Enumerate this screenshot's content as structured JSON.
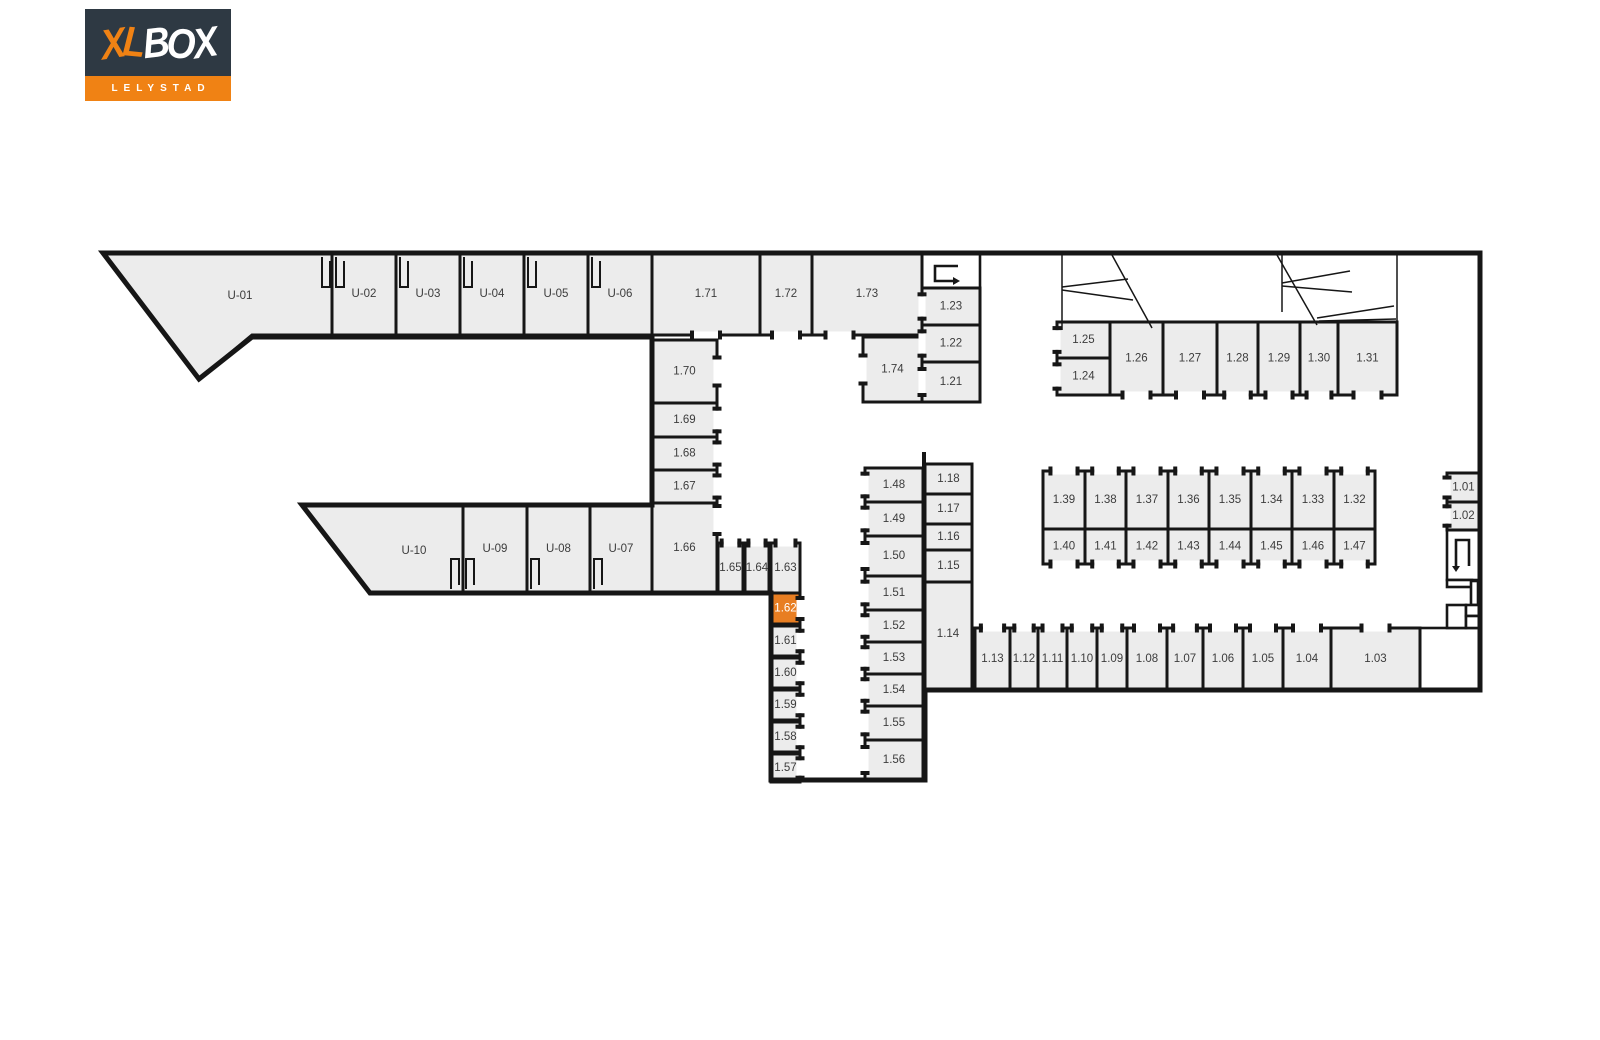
{
  "logo": {
    "brand_xl": "XL",
    "brand_box": "BOX",
    "city": "LELYSTAD"
  },
  "colors": {
    "highlight": "#E87E22",
    "unit_fill": "#ECECEC",
    "open_fill": "#FFFFFF",
    "wall": "#161616",
    "label": "#3C3C3C",
    "highlight_label": "#FFFFFF",
    "logo_bg": "#2E3943",
    "logo_orange": "#F08214"
  },
  "floorplan": {
    "units": [
      {
        "id": "U-01",
        "pts": [
          [
            103,
            253
          ],
          [
            332,
            253
          ],
          [
            332,
            335
          ],
          [
            252,
            335
          ],
          [
            199,
            379
          ]
        ],
        "lx": 240,
        "ly": 296
      },
      {
        "id": "U-02",
        "x": 332,
        "y": 253,
        "w": 64,
        "h": 82
      },
      {
        "id": "U-03",
        "x": 396,
        "y": 253,
        "w": 64,
        "h": 82
      },
      {
        "id": "U-04",
        "x": 460,
        "y": 253,
        "w": 64,
        "h": 82
      },
      {
        "id": "U-05",
        "x": 524,
        "y": 253,
        "w": 64,
        "h": 82
      },
      {
        "id": "U-06",
        "x": 588,
        "y": 253,
        "w": 64,
        "h": 82
      },
      {
        "id": "1.71",
        "x": 652,
        "y": 253,
        "w": 108,
        "h": 82,
        "door": [
          "bottom",
          0.5
        ]
      },
      {
        "id": "1.72",
        "x": 760,
        "y": 253,
        "w": 52,
        "h": 82,
        "door": [
          "bottom",
          0.5
        ]
      },
      {
        "id": "1.73",
        "x": 812,
        "y": 253,
        "w": 110,
        "h": 82,
        "door": [
          "bottom",
          0.25
        ]
      },
      {
        "id": "1.74",
        "x": 863,
        "y": 337,
        "w": 59,
        "h": 65,
        "door": [
          "left",
          0.5
        ]
      },
      {
        "id": "1.23",
        "x": 922,
        "y": 288,
        "w": 58,
        "h": 37,
        "door": [
          "left",
          0.5
        ]
      },
      {
        "id": "1.22",
        "x": 922,
        "y": 325,
        "w": 58,
        "h": 37,
        "door": [
          "left",
          0.5
        ]
      },
      {
        "id": "1.21",
        "x": 922,
        "y": 362,
        "w": 58,
        "h": 40,
        "door": [
          "left",
          0.5
        ]
      },
      {
        "id": "1.70",
        "x": 652,
        "y": 340,
        "w": 65,
        "h": 63,
        "door": [
          "right",
          0.5
        ]
      },
      {
        "id": "1.69",
        "x": 652,
        "y": 403,
        "w": 65,
        "h": 34,
        "door": [
          "right",
          0.5
        ]
      },
      {
        "id": "1.68",
        "x": 652,
        "y": 437,
        "w": 65,
        "h": 33,
        "door": [
          "right",
          0.5
        ]
      },
      {
        "id": "1.67",
        "x": 652,
        "y": 470,
        "w": 65,
        "h": 33,
        "door": [
          "right",
          0.5
        ]
      },
      {
        "id": "1.66",
        "x": 652,
        "y": 503,
        "w": 65,
        "h": 90,
        "door": [
          "right",
          0.18
        ]
      },
      {
        "id": "U-10",
        "pts": [
          [
            302,
            505
          ],
          [
            463,
            505
          ],
          [
            463,
            593
          ],
          [
            370,
            593
          ]
        ],
        "lx": 414,
        "ly": 551
      },
      {
        "id": "U-09",
        "x": 463,
        "y": 505,
        "w": 64,
        "h": 88
      },
      {
        "id": "U-08",
        "x": 527,
        "y": 505,
        "w": 63,
        "h": 88
      },
      {
        "id": "U-07",
        "x": 590,
        "y": 505,
        "w": 62,
        "h": 88
      },
      {
        "id": "1.65",
        "x": 718,
        "y": 543,
        "w": 25,
        "h": 50,
        "door": [
          "top",
          0.5
        ]
      },
      {
        "id": "1.64",
        "x": 745,
        "y": 543,
        "w": 24,
        "h": 50,
        "door": [
          "top",
          0.5
        ]
      },
      {
        "id": "1.63",
        "x": 771,
        "y": 543,
        "w": 29,
        "h": 50,
        "door": [
          "top",
          0.5
        ]
      },
      {
        "id": "1.62",
        "x": 771,
        "y": 593,
        "w": 29,
        "h": 31,
        "hl": true,
        "door": [
          "right",
          0.5
        ]
      },
      {
        "id": "1.61",
        "x": 771,
        "y": 626,
        "w": 29,
        "h": 30,
        "door": [
          "right",
          0.5
        ]
      },
      {
        "id": "1.60",
        "x": 771,
        "y": 658,
        "w": 29,
        "h": 30,
        "door": [
          "right",
          0.5
        ]
      },
      {
        "id": "1.59",
        "x": 771,
        "y": 690,
        "w": 29,
        "h": 30,
        "door": [
          "right",
          0.5
        ]
      },
      {
        "id": "1.58",
        "x": 771,
        "y": 722,
        "w": 29,
        "h": 30,
        "door": [
          "right",
          0.5
        ]
      },
      {
        "id": "1.57",
        "x": 771,
        "y": 754,
        "w": 29,
        "h": 28,
        "door": [
          "right",
          0.5
        ]
      },
      {
        "id": "1.48",
        "x": 865,
        "y": 468,
        "w": 58,
        "h": 34,
        "door": [
          "left",
          0.5
        ]
      },
      {
        "id": "1.49",
        "x": 865,
        "y": 502,
        "w": 58,
        "h": 34,
        "door": [
          "left",
          0.5
        ]
      },
      {
        "id": "1.50",
        "x": 865,
        "y": 536,
        "w": 58,
        "h": 40,
        "door": [
          "left",
          0.5
        ]
      },
      {
        "id": "1.51",
        "x": 865,
        "y": 576,
        "w": 58,
        "h": 34,
        "door": [
          "left",
          0.5
        ]
      },
      {
        "id": "1.52",
        "x": 865,
        "y": 610,
        "w": 58,
        "h": 32,
        "door": [
          "left",
          0.5
        ]
      },
      {
        "id": "1.53",
        "x": 865,
        "y": 642,
        "w": 58,
        "h": 32,
        "door": [
          "left",
          0.5
        ]
      },
      {
        "id": "1.54",
        "x": 865,
        "y": 674,
        "w": 58,
        "h": 32,
        "door": [
          "left",
          0.5
        ]
      },
      {
        "id": "1.55",
        "x": 865,
        "y": 706,
        "w": 58,
        "h": 34,
        "door": [
          "left",
          0.5
        ]
      },
      {
        "id": "1.56",
        "x": 865,
        "y": 740,
        "w": 58,
        "h": 40,
        "door": [
          "left",
          0.5
        ]
      },
      {
        "id": "1.18",
        "x": 925,
        "y": 464,
        "w": 47,
        "h": 30
      },
      {
        "id": "1.17",
        "x": 925,
        "y": 494,
        "w": 47,
        "h": 30
      },
      {
        "id": "1.16",
        "x": 925,
        "y": 524,
        "w": 47,
        "h": 26
      },
      {
        "id": "1.15",
        "x": 925,
        "y": 550,
        "w": 47,
        "h": 32
      },
      {
        "id": "1.14",
        "x": 925,
        "y": 582,
        "w": 47,
        "h": 108,
        "lx": 948,
        "ly": 634
      },
      {
        "id": "1.13",
        "x": 975,
        "y": 628,
        "w": 35,
        "h": 62,
        "door": [
          "top",
          0.5
        ]
      },
      {
        "id": "1.12",
        "x": 1010,
        "y": 628,
        "w": 28,
        "h": 62,
        "door": [
          "top",
          0.5
        ]
      },
      {
        "id": "1.11",
        "x": 1038,
        "y": 628,
        "w": 29,
        "h": 62,
        "door": [
          "top",
          0.5
        ]
      },
      {
        "id": "1.10",
        "x": 1067,
        "y": 628,
        "w": 30,
        "h": 62,
        "door": [
          "top",
          0.5
        ]
      },
      {
        "id": "1.09",
        "x": 1097,
        "y": 628,
        "w": 30,
        "h": 62,
        "door": [
          "top",
          0.5
        ]
      },
      {
        "id": "1.08",
        "x": 1127,
        "y": 628,
        "w": 40,
        "h": 62,
        "door": [
          "top",
          0.5
        ]
      },
      {
        "id": "1.07",
        "x": 1167,
        "y": 628,
        "w": 36,
        "h": 62,
        "door": [
          "top",
          0.5
        ]
      },
      {
        "id": "1.06",
        "x": 1203,
        "y": 628,
        "w": 40,
        "h": 62,
        "door": [
          "top",
          0.5
        ]
      },
      {
        "id": "1.05",
        "x": 1243,
        "y": 628,
        "w": 40,
        "h": 62,
        "door": [
          "top",
          0.5
        ]
      },
      {
        "id": "1.04",
        "x": 1283,
        "y": 628,
        "w": 48,
        "h": 62,
        "door": [
          "top",
          0.5
        ]
      },
      {
        "id": "1.03",
        "x": 1331,
        "y": 628,
        "w": 89,
        "h": 62,
        "door": [
          "top",
          0.5
        ]
      },
      {
        "id": "1.25",
        "x": 1057,
        "y": 322,
        "w": 53,
        "h": 36,
        "door": [
          "left",
          0.5
        ]
      },
      {
        "id": "1.24",
        "x": 1057,
        "y": 358,
        "w": 53,
        "h": 37,
        "door": [
          "left",
          0.5
        ]
      },
      {
        "id": "1.26",
        "x": 1110,
        "y": 322,
        "w": 53,
        "h": 73,
        "door": [
          "bottom",
          0.5
        ]
      },
      {
        "id": "1.27",
        "x": 1163,
        "y": 322,
        "w": 54,
        "h": 73,
        "door": [
          "bottom",
          0.5
        ]
      },
      {
        "id": "1.28",
        "x": 1217,
        "y": 322,
        "w": 41,
        "h": 73,
        "door": [
          "bottom",
          0.5
        ]
      },
      {
        "id": "1.29",
        "x": 1258,
        "y": 322,
        "w": 42,
        "h": 73,
        "door": [
          "bottom",
          0.5
        ]
      },
      {
        "id": "1.30",
        "x": 1300,
        "y": 322,
        "w": 38,
        "h": 73,
        "door": [
          "bottom",
          0.5
        ]
      },
      {
        "id": "1.31",
        "x": 1338,
        "y": 322,
        "w": 59,
        "h": 73,
        "door": [
          "bottom",
          0.5
        ]
      },
      {
        "id": "1.39",
        "x": 1043,
        "y": 471,
        "w": 42,
        "h": 58,
        "door": [
          "top",
          0.5
        ]
      },
      {
        "id": "1.38",
        "x": 1085,
        "y": 471,
        "w": 41,
        "h": 58,
        "door": [
          "top",
          0.5
        ]
      },
      {
        "id": "1.37",
        "x": 1126,
        "y": 471,
        "w": 42,
        "h": 58,
        "door": [
          "top",
          0.5
        ]
      },
      {
        "id": "1.36",
        "x": 1168,
        "y": 471,
        "w": 41,
        "h": 58,
        "door": [
          "top",
          0.5
        ]
      },
      {
        "id": "1.35",
        "x": 1209,
        "y": 471,
        "w": 42,
        "h": 58,
        "door": [
          "top",
          0.5
        ]
      },
      {
        "id": "1.34",
        "x": 1251,
        "y": 471,
        "w": 41,
        "h": 58,
        "door": [
          "top",
          0.5
        ]
      },
      {
        "id": "1.33",
        "x": 1292,
        "y": 471,
        "w": 42,
        "h": 58,
        "door": [
          "top",
          0.5
        ]
      },
      {
        "id": "1.32",
        "x": 1334,
        "y": 471,
        "w": 41,
        "h": 58,
        "door": [
          "top",
          0.5
        ]
      },
      {
        "id": "1.40",
        "x": 1043,
        "y": 529,
        "w": 42,
        "h": 35,
        "door": [
          "bottom",
          0.5
        ]
      },
      {
        "id": "1.41",
        "x": 1085,
        "y": 529,
        "w": 41,
        "h": 35,
        "door": [
          "bottom",
          0.5
        ]
      },
      {
        "id": "1.42",
        "x": 1126,
        "y": 529,
        "w": 42,
        "h": 35,
        "door": [
          "bottom",
          0.5
        ]
      },
      {
        "id": "1.43",
        "x": 1168,
        "y": 529,
        "w": 41,
        "h": 35,
        "door": [
          "bottom",
          0.5
        ]
      },
      {
        "id": "1.44",
        "x": 1209,
        "y": 529,
        "w": 42,
        "h": 35,
        "door": [
          "bottom",
          0.5
        ]
      },
      {
        "id": "1.45",
        "x": 1251,
        "y": 529,
        "w": 41,
        "h": 35,
        "door": [
          "bottom",
          0.5
        ]
      },
      {
        "id": "1.46",
        "x": 1292,
        "y": 529,
        "w": 42,
        "h": 35,
        "door": [
          "bottom",
          0.5
        ]
      },
      {
        "id": "1.47",
        "x": 1334,
        "y": 529,
        "w": 41,
        "h": 35,
        "door": [
          "bottom",
          0.5
        ]
      },
      {
        "id": "1.01",
        "x": 1447,
        "y": 473,
        "w": 33,
        "h": 29,
        "door": [
          "left",
          0.5
        ]
      },
      {
        "id": "1.02",
        "x": 1447,
        "y": 502,
        "w": 33,
        "h": 28,
        "door": [
          "left",
          0.5
        ]
      }
    ],
    "open_rooms": [
      {
        "name": "stairwell-top",
        "x": 922,
        "y": 253,
        "w": 58,
        "h": 35
      },
      {
        "name": "stairwell-right",
        "x": 1447,
        "y": 530,
        "w": 33,
        "h": 50
      },
      {
        "name": "utility-room",
        "x": 1420,
        "y": 628,
        "w": 60,
        "h": 62
      },
      {
        "name": "utility-room",
        "x": 1447,
        "y": 580,
        "w": 25,
        "h": 7
      },
      {
        "name": "utility-room",
        "x": 1471,
        "y": 581,
        "w": 7,
        "h": 24
      },
      {
        "name": "utility-room",
        "x": 1447,
        "y": 605,
        "w": 19,
        "h": 23
      },
      {
        "name": "utility-room",
        "x": 1466,
        "y": 605,
        "w": 14,
        "h": 11
      },
      {
        "name": "utility-room",
        "x": 1466,
        "y": 616,
        "w": 14,
        "h": 12
      }
    ],
    "outline": "M103,253 L1480,253 L1480,690 L925,690 L925,780 L771,780 L771,593 L370,593 L302,505 L652,505 L652,337 L252,337 L199,379 Z",
    "extra_walls": [
      [
        924,
        452,
        924,
        468
      ]
    ],
    "gates": [
      [
        1062,
        255,
        1062,
        330
      ],
      [
        1062,
        287,
        1128,
        279
      ],
      [
        1062,
        290,
        1133,
        300
      ],
      [
        1112,
        255,
        1152,
        328
      ],
      [
        1282,
        255,
        1282,
        312
      ],
      [
        1282,
        283,
        1350,
        271
      ],
      [
        1282,
        286,
        1352,
        292
      ],
      [
        1277,
        255,
        1317,
        325
      ],
      [
        1317,
        318,
        1394,
        306
      ],
      [
        1319,
        321,
        1396,
        319
      ],
      [
        1397,
        255,
        1397,
        322
      ]
    ],
    "door_brackets": [
      {
        "x": 322,
        "y": 257,
        "d": 1
      },
      {
        "x": 336,
        "y": 257,
        "d": 1
      },
      {
        "x": 400,
        "y": 257,
        "d": 1
      },
      {
        "x": 464,
        "y": 257,
        "d": 1
      },
      {
        "x": 528,
        "y": 257,
        "d": 1
      },
      {
        "x": 592,
        "y": 257,
        "d": 1
      },
      {
        "x": 451,
        "y": 589,
        "d": -1
      },
      {
        "x": 466,
        "y": 589,
        "d": -1
      },
      {
        "x": 531,
        "y": 589,
        "d": -1
      },
      {
        "x": 594,
        "y": 589,
        "d": -1
      }
    ],
    "stairs": [
      {
        "name": "stair-arrow-top",
        "pts": [
          [
            958,
            266
          ],
          [
            935,
            266
          ],
          [
            935,
            281
          ],
          [
            953,
            281
          ]
        ],
        "arrow": [
          [
            953,
            277
          ],
          [
            953,
            285
          ],
          [
            960,
            281
          ]
        ]
      },
      {
        "name": "stair-arrow-right",
        "pts": [
          [
            1456,
            566
          ],
          [
            1456,
            540
          ],
          [
            1469,
            540
          ],
          [
            1469,
            566
          ]
        ],
        "arrow": [
          [
            1452,
            566
          ],
          [
            1460,
            566
          ],
          [
            1456,
            572
          ]
        ]
      }
    ]
  }
}
